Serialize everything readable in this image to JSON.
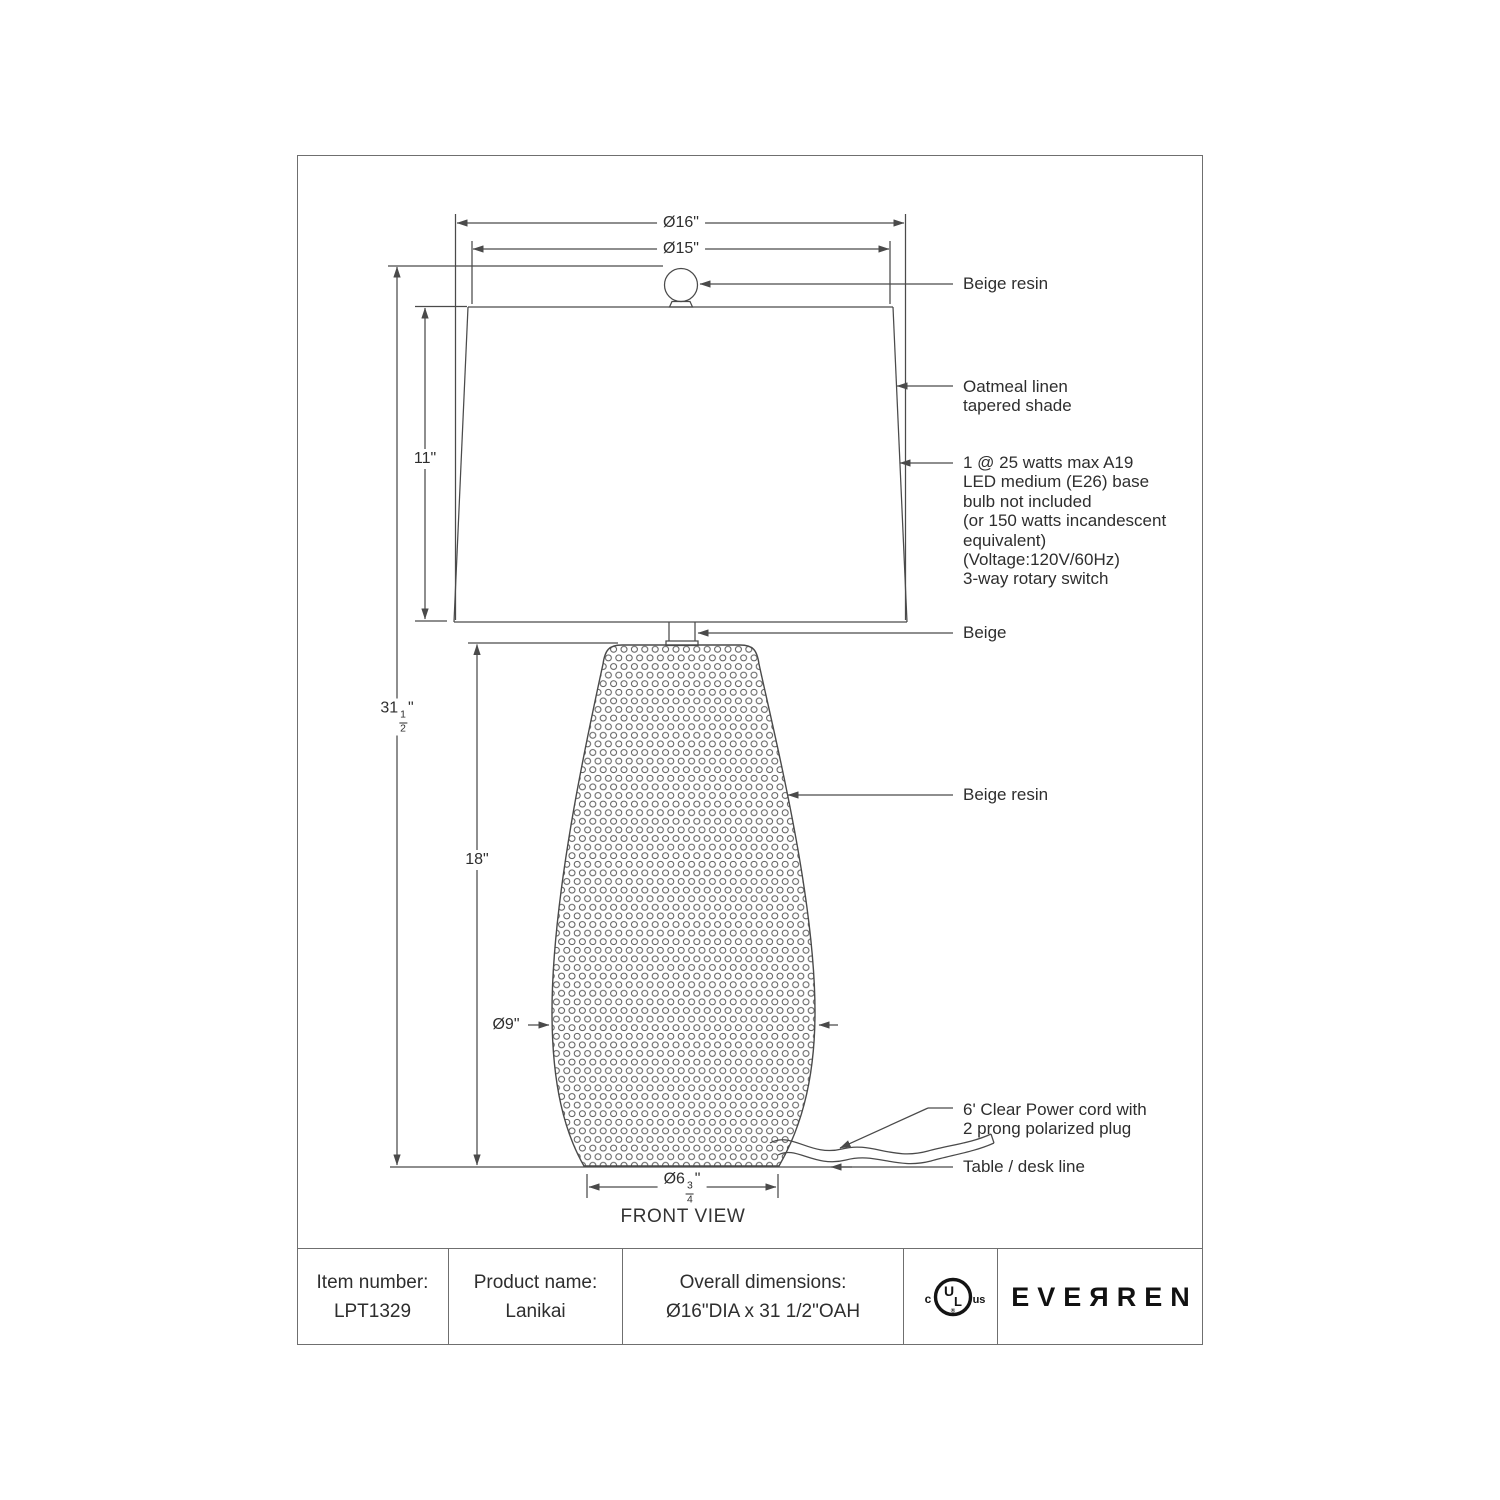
{
  "drawing": {
    "view_label": "FRONT VIEW",
    "dims": {
      "d16": "Ø16\"",
      "d15": "Ø15\"",
      "d11": "11\"",
      "d31": {
        "whole": "31",
        "num": "1",
        "den": "2",
        "unit": "\""
      },
      "d18": "18\"",
      "d9": "Ø9\"",
      "d675": {
        "whole": "Ø6",
        "num": "3",
        "den": "4",
        "unit": "\""
      }
    },
    "callouts": {
      "finial": "Beige resin",
      "shade": [
        "Oatmeal linen",
        "tapered shade"
      ],
      "bulb": [
        "1 @ 25 watts max A19",
        "LED medium (E26) base",
        "bulb not included",
        "(or 150 watts incandescent",
        "equivalent)",
        "(Voltage:120V/60Hz)",
        "3-way rotary switch"
      ],
      "neck": "Beige",
      "body": "Beige resin",
      "cord": [
        "6' Clear Power cord with",
        "2 prong polarized plug"
      ],
      "table_line": "Table / desk line"
    }
  },
  "title_block": {
    "item": {
      "label": "Item number:",
      "value": "LPT1329"
    },
    "product": {
      "label": "Product name:",
      "value": "Lanikai"
    },
    "overall": {
      "label": "Overall dimensions:",
      "value": "Ø16\"DIA x 31 1/2\"OAH"
    },
    "ul": {
      "c": "c",
      "ul_u": "U",
      "ul_l": "L",
      "us": "us",
      "reg": "®"
    },
    "brand": "EVEЯREN"
  }
}
